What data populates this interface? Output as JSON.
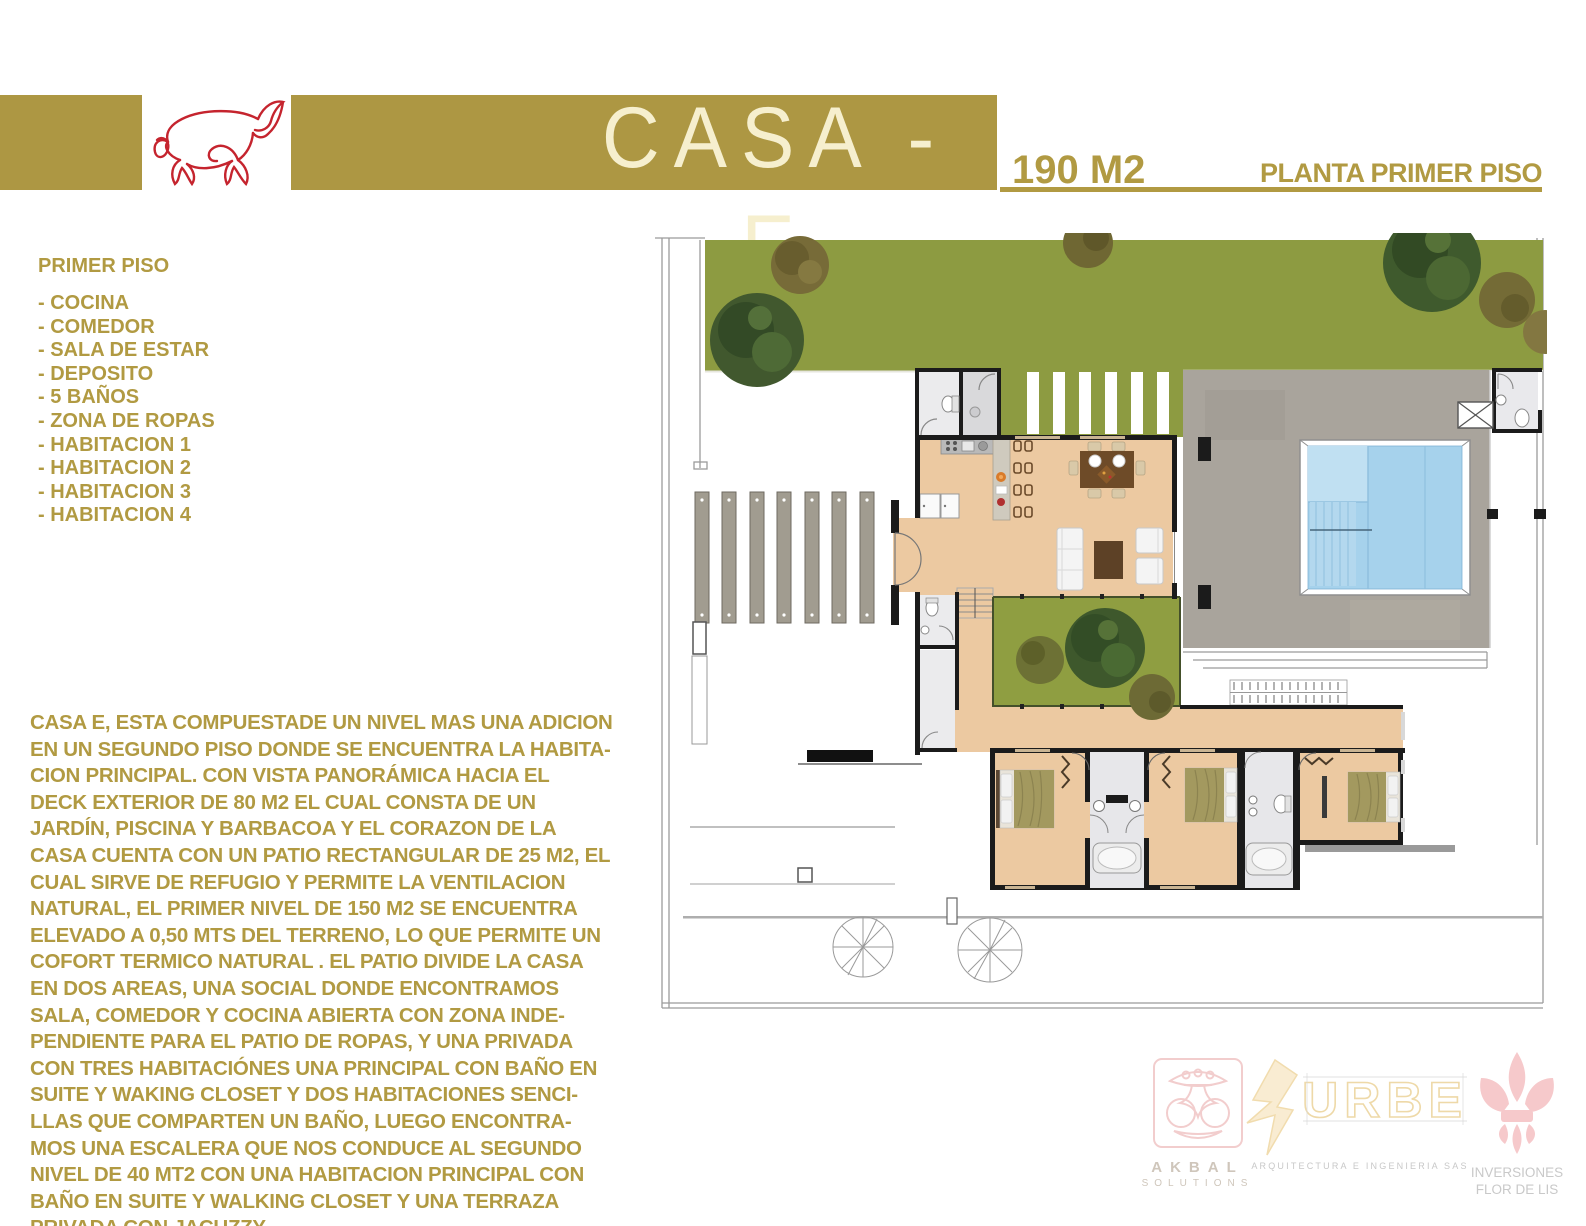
{
  "header": {
    "title": "CASA - E",
    "area_label": "190 M2",
    "plan_label": "PLANTA PRIMER PISO"
  },
  "first_floor": {
    "heading": "PRIMER PISO",
    "items": [
      "- COCINA",
      "- COMEDOR",
      "- SALA DE ESTAR",
      "- DEPOSITO",
      "- 5 BAÑOS",
      "- ZONA DE ROPAS",
      "- HABITACION 1",
      "- HABITACION 2",
      "- HABITACION 3",
      "- HABITACION 4"
    ]
  },
  "description": "CASA E, ESTA COMPUESTADE UN NIVEL MAS UNA ADICION\nEN UN SEGUNDO PISO DONDE SE ENCUENTRA LA HABITA-\nCION PRINCIPAL. CON VISTA PANORÁMICA HACIA  EL\nDECK EXTERIOR DE 80 M2  EL CUAL CONSTA DE UN\nJARDÍN, PISCINA Y BARBACOA Y  EL  CORAZON DE LA\nCASA CUENTA CON UN PATIO RECTANGULAR DE 25 M2, EL\nCUAL SIRVE DE REFUGIO Y PERMITE LA VENTILACION\nNATURAL, EL  PRIMER NIVEL DE 150 M2 SE ENCUENTRA\nELEVADO A 0,50 MTS DEL TERRENO, LO QUE PERMITE UN\nCOFORT  TERMICO NATURAL . EL PATIO DIVIDE LA CASA\nEN DOS AREAS, UNA SOCIAL DONDE ENCONTRAMOS\nSALA, COMEDOR Y  COCINA ABIERTA CON ZONA INDE-\nPENDIENTE PARA EL PATIO DE ROPAS, Y UNA PRIVADA\nCON TRES HABITACIÓNES UNA PRINCIPAL CON BAÑO EN\nSUITE Y WAKING CLOSET Y DOS HABITACIONES SENCI-\nLLAS QUE COMPARTEN UN BAÑO, LUEGO ENCONTRA-\nMOS UNA ESCALERA QUE NOS CONDUCE AL SEGUNDO\nNIVEL DE 40 MT2 CON UNA HABITACION PRINCIPAL CON\nBAÑO EN SUITE Y WALKING CLOSET Y UNA TERRAZA\nPRIVADA CON JACUZZY",
  "footer_logos": {
    "akbal": {
      "name": "AKBAL",
      "subtitle": "SOLUTIONS"
    },
    "urbe": {
      "name": "URBE",
      "subtitle": "ARQUITECTURA E INGENIERIA SAS"
    },
    "flor_de_lis": {
      "line1": "INVERSIONES",
      "line2": "FLOR DE LIS"
    }
  },
  "colors": {
    "gold": "#b19a42",
    "header_bar": "#ad9743",
    "title_cream": "#f6efce",
    "bull_red": "#c5242e",
    "lawn_green": "#8d9b41",
    "patio_green": "#8f9e41",
    "floor_peach": "#ecc9a1",
    "deck_gray": "#a9a49c",
    "pool_blue": "#a6d2ec",
    "wall_black": "#1b1b1b"
  }
}
